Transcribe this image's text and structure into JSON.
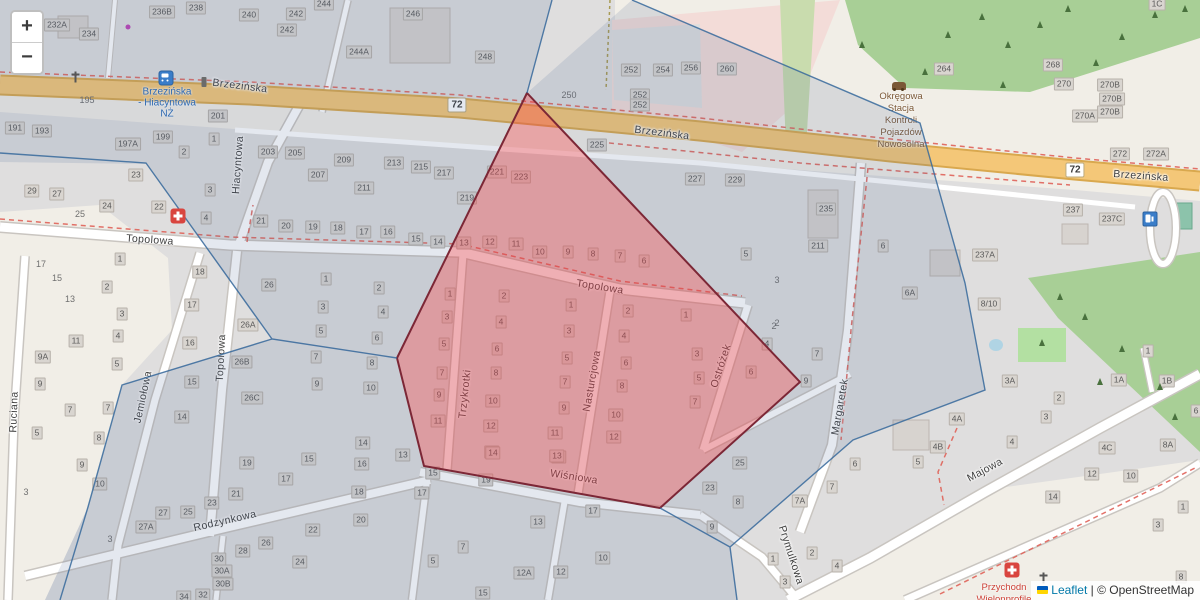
{
  "app": {
    "kind": "leaflet-map-view"
  },
  "controls": {
    "zoom_in": "+",
    "zoom_out": "−"
  },
  "attribution": {
    "leaflet": "Leaflet",
    "separator": " | ",
    "osm": "© OpenStreetMap",
    "flag_icon": "ukraine-flag"
  },
  "colors": {
    "selection_fill": "#da414d",
    "selection_border": "#7c2736",
    "boundary_line": "#36689b",
    "road_primary": "#f4c778",
    "forest": "#a8cf96",
    "tint": "rgba(74,104,146,0.15)",
    "transit_blue": "#2a6ab5",
    "poi_brown": "#7b5836",
    "poi_red": "#cc4036"
  },
  "route_badges": [
    {
      "label": "72",
      "x": 457,
      "y": 105
    },
    {
      "label": "72",
      "x": 1075,
      "y": 170
    }
  ],
  "street_labels": [
    {
      "name": "Brzezińska",
      "x": 240,
      "y": 86,
      "rot": 7
    },
    {
      "name": "Brzezińska",
      "x": 662,
      "y": 133,
      "rot": 7
    },
    {
      "name": "Brzezińska",
      "x": 1141,
      "y": 176,
      "rot": 4
    },
    {
      "name": "Topolowa",
      "x": 150,
      "y": 240,
      "rot": 4
    },
    {
      "name": "Topolowa",
      "x": 600,
      "y": 287,
      "rot": 9
    },
    {
      "name": "Topolowa",
      "x": 221,
      "y": 358,
      "rot": -87
    },
    {
      "name": "Hiacyntowa",
      "x": 238,
      "y": 165,
      "rot": -86
    },
    {
      "name": "Ruciana",
      "x": 14,
      "y": 412,
      "rot": -88
    },
    {
      "name": "Jemiołowa",
      "x": 143,
      "y": 397,
      "rot": -78
    },
    {
      "name": "Trzykrotki",
      "x": 465,
      "y": 394,
      "rot": -84
    },
    {
      "name": "Nasturcjowa",
      "x": 592,
      "y": 381,
      "rot": -80
    },
    {
      "name": "Ostróżek",
      "x": 721,
      "y": 366,
      "rot": -72
    },
    {
      "name": "Margaretek",
      "x": 840,
      "y": 407,
      "rot": -80
    },
    {
      "name": "Wiśniowa",
      "x": 574,
      "y": 477,
      "rot": 9
    },
    {
      "name": "Rodzynkowa",
      "x": 225,
      "y": 521,
      "rot": -13
    },
    {
      "name": "Majowa",
      "x": 985,
      "y": 470,
      "rot": -28
    },
    {
      "name": "Prymulkowa",
      "x": 791,
      "y": 555,
      "rot": 72
    }
  ],
  "transit_stop": {
    "lines": [
      "Brzezińska",
      "- Hiacyntowa",
      "NŻ"
    ],
    "x": 167,
    "y": 103
  },
  "poi_texts": [
    {
      "id": "vehicle-inspection-station",
      "lines": [
        "Okręgowa",
        "Stacja",
        "Kontroli",
        "Pojazdów",
        "Nowosolna"
      ],
      "x": 901,
      "y": 121,
      "color": "#7b5836"
    },
    {
      "id": "clinic",
      "lines": [
        "Przychodn",
        "Wielonprofile"
      ],
      "x": 1004,
      "y": 594,
      "color": "#cc4036"
    }
  ],
  "house_numbers": [
    [
      "232A",
      57,
      25
    ],
    [
      "234",
      89,
      34
    ],
    [
      "236B",
      162,
      12
    ],
    [
      "238",
      196,
      8
    ],
    [
      "240",
      249,
      15
    ],
    [
      "242",
      296,
      14
    ],
    [
      "242",
      287,
      30
    ],
    [
      "244",
      324,
      4
    ],
    [
      "244A",
      359,
      52
    ],
    [
      "246",
      413,
      14
    ],
    [
      "248",
      485,
      57
    ],
    [
      "252",
      631,
      70
    ],
    [
      "254",
      663,
      70
    ],
    [
      "256",
      691,
      68
    ],
    [
      "260",
      727,
      69
    ],
    [
      "252",
      640,
      95
    ],
    [
      "252",
      640,
      105
    ],
    [
      "264",
      944,
      69
    ],
    [
      "268",
      1053,
      65
    ],
    [
      "270",
      1064,
      84
    ],
    [
      "270B",
      1110,
      85
    ],
    [
      "270B",
      1112,
      99
    ],
    [
      "270B",
      1110,
      112
    ],
    [
      "270A",
      1085,
      116
    ],
    [
      "272",
      1120,
      154
    ],
    [
      "272A",
      1156,
      154
    ],
    [
      "1C",
      1157,
      4
    ],
    [
      "191",
      15,
      128
    ],
    [
      "193",
      42,
      131
    ],
    [
      "197A",
      128,
      144
    ],
    [
      "199",
      163,
      137
    ],
    [
      "201",
      218,
      116
    ],
    [
      "1",
      214,
      139
    ],
    [
      "2",
      184,
      152
    ],
    [
      "203",
      268,
      152
    ],
    [
      "205",
      295,
      153
    ],
    [
      "207",
      318,
      175
    ],
    [
      "209",
      344,
      160
    ],
    [
      "211",
      364,
      188
    ],
    [
      "213",
      394,
      163
    ],
    [
      "215",
      421,
      167
    ],
    [
      "217",
      444,
      173
    ],
    [
      "219",
      467,
      198
    ],
    [
      "221",
      497,
      172
    ],
    [
      "223",
      521,
      177
    ],
    [
      "225",
      597,
      145
    ],
    [
      "227",
      695,
      179
    ],
    [
      "229",
      735,
      180
    ],
    [
      "235",
      826,
      209
    ],
    [
      "211",
      818,
      246
    ],
    [
      "6",
      883,
      246
    ],
    [
      "6A",
      910,
      293
    ],
    [
      "237A",
      985,
      255
    ],
    [
      "237",
      1073,
      210
    ],
    [
      "237C",
      1112,
      219
    ],
    [
      "8/10",
      989,
      304
    ],
    [
      "22",
      159,
      207
    ],
    [
      "3",
      210,
      190
    ],
    [
      "4",
      206,
      218
    ],
    [
      "21",
      261,
      221
    ],
    [
      "20",
      286,
      226
    ],
    [
      "19",
      313,
      227
    ],
    [
      "18",
      338,
      228
    ],
    [
      "17",
      364,
      232
    ],
    [
      "16",
      388,
      232
    ],
    [
      "15",
      416,
      239
    ],
    [
      "14",
      438,
      242
    ],
    [
      "13",
      464,
      243
    ],
    [
      "12",
      490,
      242
    ],
    [
      "11",
      516,
      244
    ],
    [
      "10",
      540,
      252
    ],
    [
      "9",
      568,
      252
    ],
    [
      "8",
      593,
      254
    ],
    [
      "7",
      620,
      256
    ],
    [
      "6",
      644,
      261
    ],
    [
      "5",
      746,
      254
    ],
    [
      "29",
      32,
      191
    ],
    [
      "27",
      57,
      194
    ],
    [
      "23",
      136,
      175
    ],
    [
      "24",
      107,
      206
    ],
    [
      "2",
      107,
      287
    ],
    [
      "1",
      120,
      259
    ],
    [
      "3",
      122,
      314
    ],
    [
      "18",
      200,
      272
    ],
    [
      "17",
      192,
      305
    ],
    [
      "16",
      190,
      343
    ],
    [
      "15",
      192,
      382
    ],
    [
      "14",
      182,
      417
    ],
    [
      "26",
      269,
      285
    ],
    [
      "26A",
      248,
      325
    ],
    [
      "26B",
      242,
      362
    ],
    [
      "26C",
      252,
      398
    ],
    [
      "1",
      326,
      279
    ],
    [
      "3",
      323,
      307
    ],
    [
      "5",
      321,
      331
    ],
    [
      "7",
      316,
      357
    ],
    [
      "9",
      317,
      384
    ],
    [
      "2",
      379,
      288
    ],
    [
      "4",
      383,
      312
    ],
    [
      "6",
      377,
      338
    ],
    [
      "8",
      372,
      363
    ],
    [
      "10",
      371,
      388
    ],
    [
      "1",
      450,
      294
    ],
    [
      "3",
      447,
      317
    ],
    [
      "5",
      444,
      344
    ],
    [
      "7",
      442,
      373
    ],
    [
      "9",
      439,
      395
    ],
    [
      "11",
      438,
      421
    ],
    [
      "2",
      504,
      296
    ],
    [
      "4",
      501,
      322
    ],
    [
      "6",
      497,
      349
    ],
    [
      "8",
      496,
      373
    ],
    [
      "10",
      493,
      401
    ],
    [
      "12",
      491,
      426
    ],
    [
      "14",
      492,
      452
    ],
    [
      "1",
      571,
      305
    ],
    [
      "3",
      569,
      331
    ],
    [
      "5",
      567,
      358
    ],
    [
      "7",
      565,
      382
    ],
    [
      "9",
      564,
      408
    ],
    [
      "11",
      555,
      433
    ],
    [
      "13",
      559,
      457
    ],
    [
      "2",
      628,
      311
    ],
    [
      "4",
      624,
      336
    ],
    [
      "6",
      626,
      363
    ],
    [
      "8",
      622,
      386
    ],
    [
      "10",
      616,
      415
    ],
    [
      "12",
      614,
      437
    ],
    [
      "1",
      686,
      315
    ],
    [
      "3",
      697,
      354
    ],
    [
      "5",
      699,
      378
    ],
    [
      "7",
      695,
      402
    ],
    [
      "6",
      751,
      372
    ],
    [
      "4",
      767,
      344
    ],
    [
      "7",
      817,
      354
    ],
    [
      "9",
      806,
      381
    ],
    [
      "11",
      76,
      341
    ],
    [
      "4",
      118,
      336
    ],
    [
      "9A",
      43,
      357
    ],
    [
      "5",
      117,
      364
    ],
    [
      "9",
      40,
      384
    ],
    [
      "7",
      70,
      410
    ],
    [
      "7",
      108,
      408
    ],
    [
      "5",
      37,
      433
    ],
    [
      "8",
      99,
      438
    ],
    [
      "9",
      82,
      465
    ],
    [
      "10",
      100,
      484
    ],
    [
      "19",
      247,
      463
    ],
    [
      "27",
      163,
      513
    ],
    [
      "25",
      188,
      512
    ],
    [
      "27A",
      146,
      527
    ],
    [
      "23",
      212,
      503
    ],
    [
      "21",
      236,
      494
    ],
    [
      "17",
      286,
      479
    ],
    [
      "18",
      359,
      492
    ],
    [
      "20",
      361,
      520
    ],
    [
      "22",
      313,
      530
    ],
    [
      "26",
      266,
      543
    ],
    [
      "28",
      243,
      551
    ],
    [
      "30",
      219,
      559
    ],
    [
      "30A",
      222,
      571
    ],
    [
      "30B",
      223,
      584
    ],
    [
      "24",
      300,
      562
    ],
    [
      "32",
      203,
      595
    ],
    [
      "34",
      184,
      597
    ],
    [
      "14",
      363,
      443
    ],
    [
      "13",
      403,
      455
    ],
    [
      "15",
      309,
      459
    ],
    [
      "16",
      362,
      464
    ],
    [
      "15",
      433,
      473
    ],
    [
      "17",
      422,
      493
    ],
    [
      "19",
      486,
      480
    ],
    [
      "14",
      493,
      453
    ],
    [
      "13",
      557,
      456
    ],
    [
      "13",
      538,
      522
    ],
    [
      "7",
      463,
      547
    ],
    [
      "5",
      433,
      561
    ],
    [
      "12A",
      524,
      573
    ],
    [
      "12",
      561,
      572
    ],
    [
      "15",
      483,
      593
    ],
    [
      "10",
      603,
      558
    ],
    [
      "17",
      593,
      511
    ],
    [
      "25",
      740,
      463
    ],
    [
      "23",
      710,
      488
    ],
    [
      "8",
      738,
      502
    ],
    [
      "9",
      712,
      527
    ],
    [
      "1",
      773,
      559
    ],
    [
      "3",
      785,
      582
    ],
    [
      "7A",
      800,
      501
    ],
    [
      "7",
      832,
      487
    ],
    [
      "2",
      812,
      553
    ],
    [
      "4",
      837,
      566
    ],
    [
      "6",
      855,
      464
    ],
    [
      "5",
      918,
      462
    ],
    [
      "4B",
      938,
      447
    ],
    [
      "4A",
      957,
      419
    ],
    [
      "3A",
      1010,
      381
    ],
    [
      "4",
      1012,
      442
    ],
    [
      "2",
      1059,
      398
    ],
    [
      "3",
      1046,
      417
    ],
    [
      "1",
      1148,
      351
    ],
    [
      "1A",
      1119,
      380
    ],
    [
      "1B",
      1167,
      381
    ],
    [
      "6",
      1196,
      411
    ],
    [
      "4C",
      1107,
      448
    ],
    [
      "8A",
      1168,
      445
    ],
    [
      "12",
      1092,
      474
    ],
    [
      "10",
      1131,
      476
    ],
    [
      "14",
      1053,
      497
    ],
    [
      "3",
      1158,
      525
    ],
    [
      "1",
      1183,
      507
    ],
    [
      "8",
      1181,
      577
    ]
  ],
  "plain_numbers": [
    [
      "250",
      569,
      95
    ],
    [
      "195",
      87,
      100
    ],
    [
      "3",
      777,
      280
    ],
    [
      "2",
      777,
      323
    ],
    [
      "25",
      80,
      214
    ],
    [
      "17",
      41,
      264
    ],
    [
      "15",
      57,
      278
    ],
    [
      "13",
      70,
      299
    ],
    [
      "3",
      26,
      492
    ],
    [
      "3",
      110,
      539
    ],
    [
      "2",
      774,
      326
    ]
  ],
  "icons": [
    {
      "type": "bus-stop",
      "x": 166,
      "y": 78
    },
    {
      "type": "stop-pole",
      "x": 204,
      "y": 82
    },
    {
      "type": "medical",
      "x": 178,
      "y": 216
    },
    {
      "type": "medical",
      "x": 1012,
      "y": 570
    },
    {
      "type": "fuel",
      "x": 1150,
      "y": 219
    },
    {
      "type": "car-repair",
      "x": 899,
      "y": 86
    },
    {
      "type": "cross",
      "x": 75,
      "y": 77
    },
    {
      "type": "cross",
      "x": 1043,
      "y": 578
    },
    {
      "type": "dot",
      "x": 128,
      "y": 27
    }
  ],
  "trees": [
    [
      948,
      38
    ],
    [
      982,
      20
    ],
    [
      1008,
      48
    ],
    [
      1040,
      28
    ],
    [
      1068,
      12
    ],
    [
      1096,
      66
    ],
    [
      1122,
      40
    ],
    [
      1155,
      18
    ],
    [
      925,
      75
    ],
    [
      1003,
      88
    ],
    [
      862,
      48
    ],
    [
      1185,
      12
    ],
    [
      1085,
      320
    ],
    [
      1122,
      352
    ],
    [
      1160,
      390
    ],
    [
      1100,
      385
    ],
    [
      1175,
      420
    ],
    [
      1060,
      300
    ],
    [
      1042,
      346
    ]
  ]
}
